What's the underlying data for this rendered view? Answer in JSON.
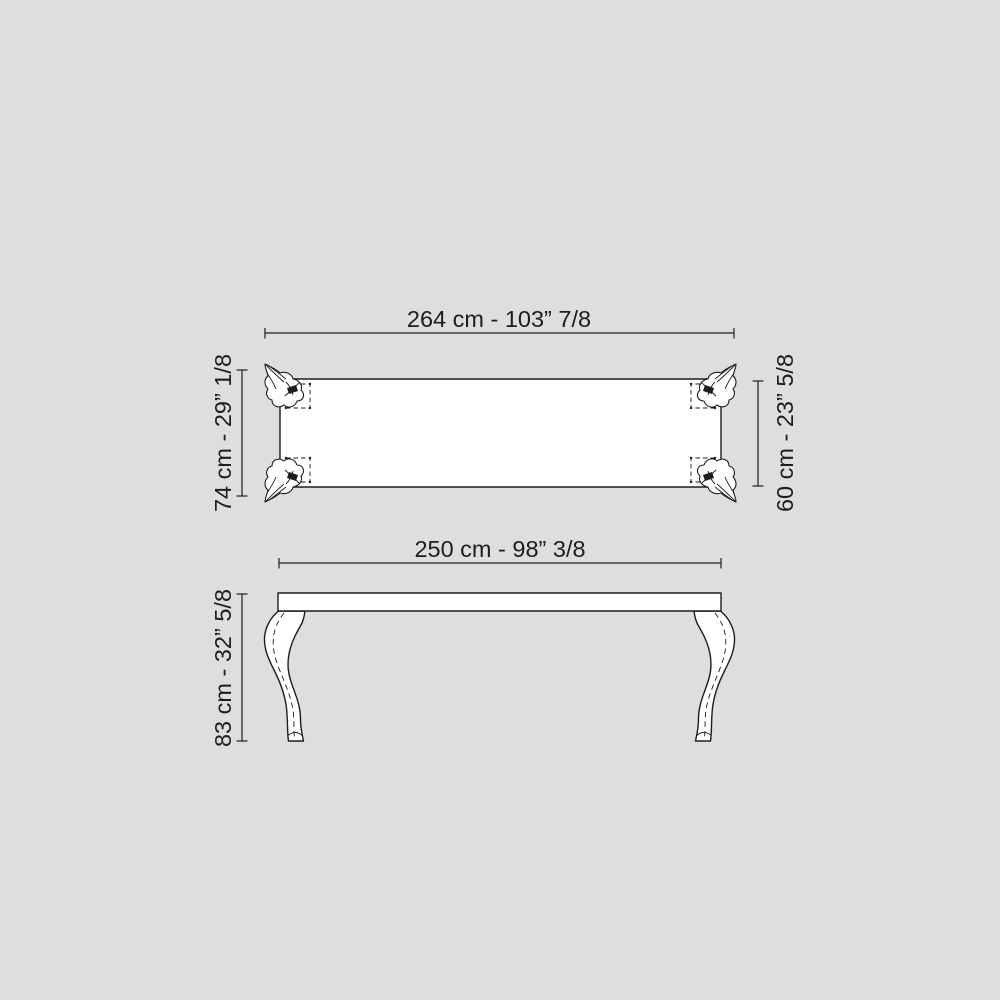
{
  "background_color": "#dedede",
  "line_color": "#1d1d1b",
  "surface_color": "#ffffff",
  "drawing": {
    "kind": "furniture technical dimension drawing",
    "top_view": {
      "overall_width_label": "264 cm - 103” 7/8",
      "overall_depth_label": "74 cm - 29” 1/8",
      "tabletop_depth_label": "60 cm - 23” 5/8"
    },
    "front_view": {
      "tabletop_width_label": "250 cm - 98” 3/8",
      "overall_height_label": "83 cm - 32” 5/8"
    }
  }
}
